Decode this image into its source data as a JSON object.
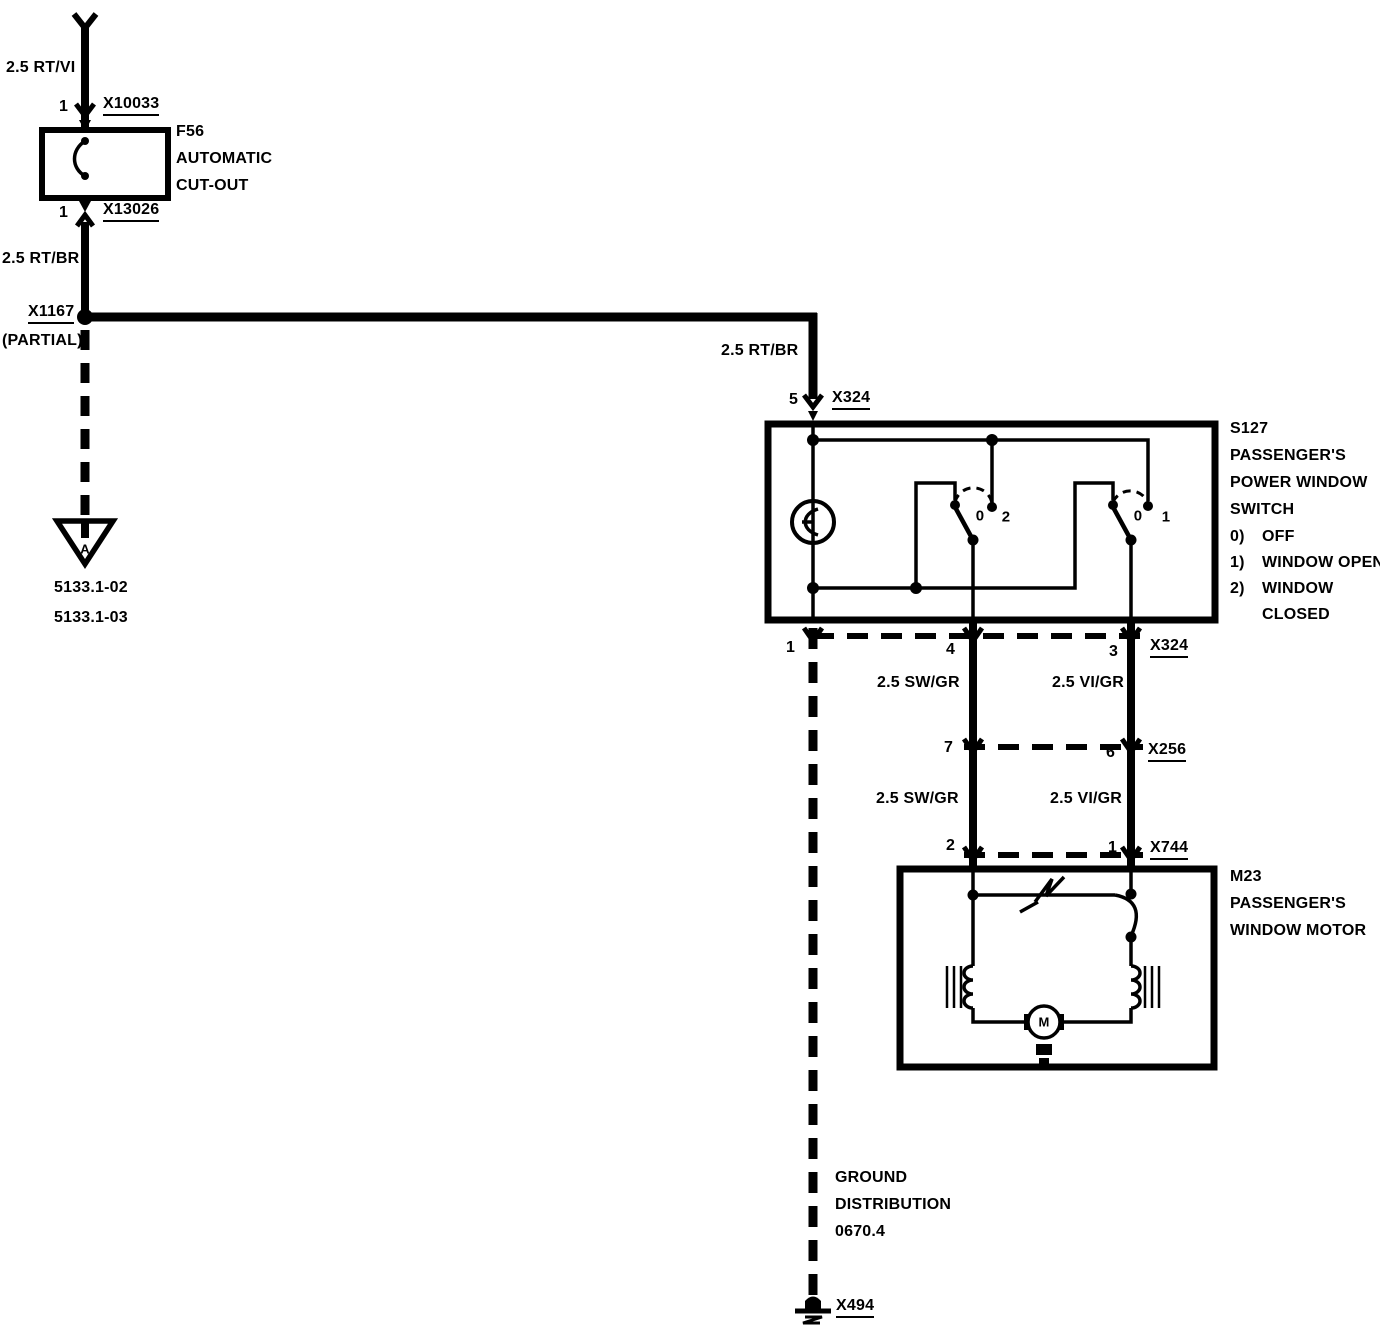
{
  "colors": {
    "ink": "#000000",
    "paper": "#ffffff"
  },
  "fuse_branch": {
    "wire_label_top": "2.5 RT/VI",
    "pin_top": "1",
    "connector_top": "X10033",
    "fuse_id": "F56",
    "fuse_name_line1": "AUTOMATIC",
    "fuse_name_line2": "CUT-OUT",
    "pin_bottom": "1",
    "connector_bottom": "X13026",
    "wire_label_bottom": "2.5 RT/BR"
  },
  "junction": {
    "id": "X1167",
    "note": "(PARTIAL)"
  },
  "offpage": {
    "letter": "A",
    "ref1": "5133.1-02",
    "ref2": "5133.1-03"
  },
  "feed": {
    "wire_label": "2.5 RT/BR",
    "pin": "5",
    "connector": "X324"
  },
  "s127": {
    "id": "S127",
    "name_line1": "PASSENGER'S",
    "name_line2": "POWER WINDOW",
    "name_line3": "SWITCH",
    "legend": [
      {
        "key": "0)",
        "text": "OFF"
      },
      {
        "key": "1)",
        "text": "WINDOW OPEN"
      },
      {
        "key": "2)",
        "text": "WINDOW"
      },
      {
        "key": "",
        "text": "CLOSED"
      }
    ],
    "contact_sw1_off": "0",
    "contact_sw1_closed": "2",
    "contact_sw2_off": "0",
    "contact_sw2_open": "1"
  },
  "row_x324": {
    "pin_ground": "1",
    "pin_left": "4",
    "pin_right": "3",
    "id": "X324"
  },
  "seg_upper": {
    "label_left": "2.5 SW/GR",
    "label_right": "2.5 VI/GR"
  },
  "row_x256": {
    "pin_left": "7",
    "pin_right": "6",
    "id": "X256"
  },
  "seg_lower": {
    "label_left": "2.5 SW/GR",
    "label_right": "2.5 VI/GR"
  },
  "row_x744": {
    "pin_left": "2",
    "pin_right": "1",
    "id": "X744"
  },
  "m23": {
    "id": "M23",
    "name_line1": "PASSENGER'S",
    "name_line2": "WINDOW MOTOR",
    "motor_letter": "M"
  },
  "ground": {
    "line1": "GROUND",
    "line2": "DISTRIBUTION",
    "line3": "0670.4",
    "connector": "X494"
  }
}
